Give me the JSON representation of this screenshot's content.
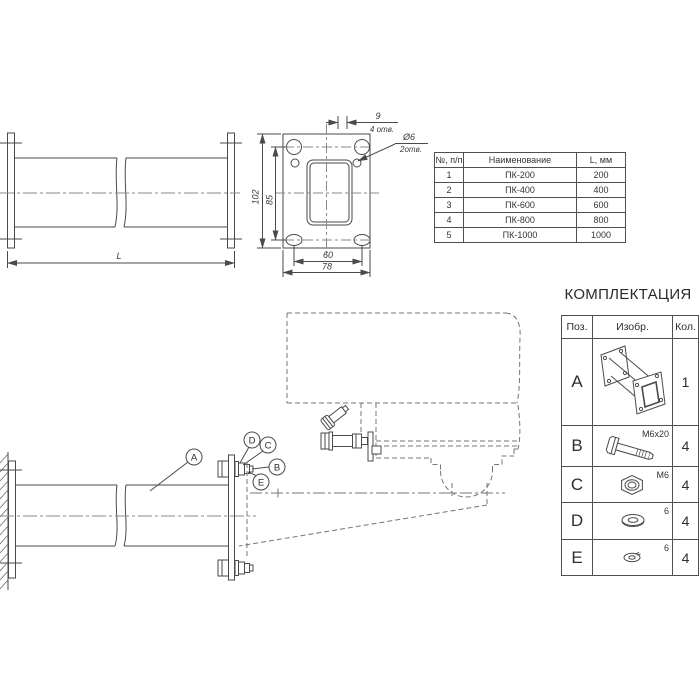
{
  "sheet": {
    "background": "#ffffff",
    "line_color": "#4a4a4a",
    "dashed_color": "#757575"
  },
  "side_view": {
    "length_dim": "L"
  },
  "flange_view": {
    "height_overall": "102",
    "height_holes": "85",
    "width_holes": "60",
    "width_overall": "78",
    "slot_dim": "9",
    "slot_note": "4 отв.",
    "hole_dia": "Ø6",
    "hole_note": "2отв."
  },
  "parts_table": {
    "headers": {
      "num": "№, п/п",
      "name": "Наименование",
      "len": "L, мм"
    },
    "rows": [
      {
        "num": "1",
        "name": "ПК-200",
        "len": "200"
      },
      {
        "num": "2",
        "name": "ПК-400",
        "len": "400"
      },
      {
        "num": "3",
        "name": "ПК-600",
        "len": "600"
      },
      {
        "num": "4",
        "name": "ПК-800",
        "len": "800"
      },
      {
        "num": "5",
        "name": "ПК-1000",
        "len": "1000"
      }
    ]
  },
  "kit": {
    "title": "КОМПЛЕКТАЦИЯ",
    "headers": {
      "pos": "Поз.",
      "image": "Изобр.",
      "qty": "Кол."
    },
    "rows": [
      {
        "pos": "A",
        "qty": "1",
        "label": "",
        "icon": "flanged-duct-isometric"
      },
      {
        "pos": "B",
        "qty": "4",
        "label": "M6x20",
        "icon": "bolt"
      },
      {
        "pos": "C",
        "qty": "4",
        "label": "M6",
        "icon": "hex-nut"
      },
      {
        "pos": "D",
        "qty": "4",
        "label": "6",
        "icon": "flat-washer"
      },
      {
        "pos": "E",
        "qty": "4",
        "label": "6",
        "icon": "spring-washer"
      }
    ]
  },
  "assembly": {
    "callout_a": "A",
    "callout_b": "B",
    "callout_c": "C",
    "callout_d": "D",
    "callout_e": "E"
  }
}
